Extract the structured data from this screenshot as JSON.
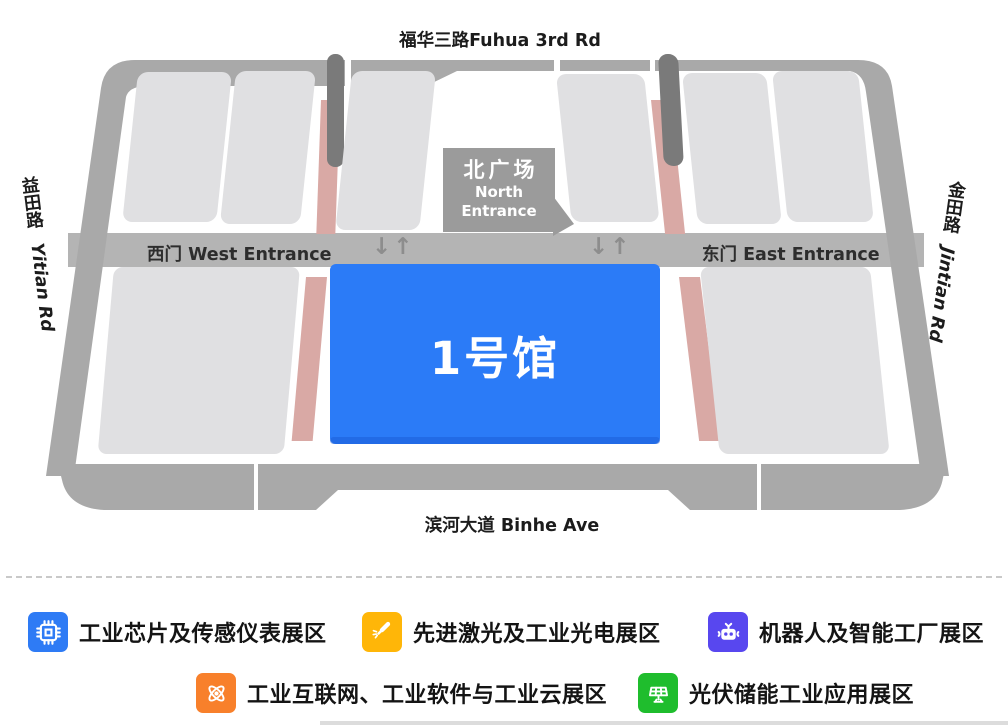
{
  "map": {
    "roads": {
      "top": "福华三路Fuhua 3rd Rd",
      "bottom": "滨河大道 Binhe Ave",
      "left_cn": "益田路",
      "left_en": "Yitian Rd",
      "right_cn": "金田路",
      "right_en": "Jintian Rd"
    },
    "entrances": {
      "west": "西门 West Entrance",
      "east": "东门 East Entrance",
      "north_plaza_cn": "北广场",
      "north_plaza_en1": "North",
      "north_plaza_en2": "Entrance"
    },
    "arrow_pair": "↓↑",
    "hall1_label": "1号馆",
    "colors": {
      "hall1": "#2b7bf7",
      "hall_gray": "#e0e0e2",
      "ring_road": "#a9a9a9",
      "road_band": "#b4b4b4",
      "pink_strip": "#d9a9a5",
      "corridor_dark": "#7a7a7a",
      "entrance_box": "#9b9b9b"
    }
  },
  "legend": {
    "items": [
      {
        "icon": "chip-icon",
        "color": "#2e7bf5",
        "label": "工业芯片及传感仪表展区"
      },
      {
        "icon": "laser-icon",
        "color": "#ffb608",
        "label": "先进激光及工业光电展区"
      },
      {
        "icon": "robot-icon",
        "color": "#5847ef",
        "label": "机器人及智能工厂展区"
      },
      {
        "icon": "network-icon",
        "color": "#f8802b",
        "label": "工业互联网、工业软件与工业云展区"
      },
      {
        "icon": "solar-icon",
        "color": "#1fbd2d",
        "label": "光伏储能工业应用展区"
      }
    ]
  }
}
